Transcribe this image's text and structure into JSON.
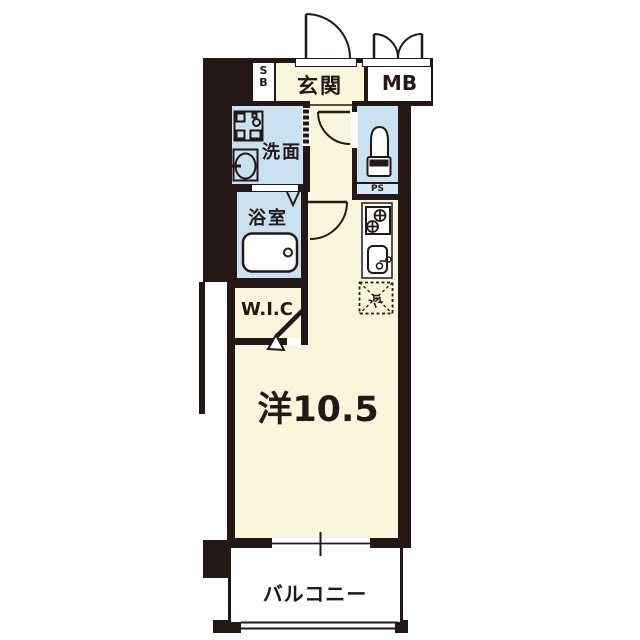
{
  "figure": {
    "type": "japanese-apartment-floor-plan"
  },
  "labels": {
    "genkan": "玄関",
    "shoes_box_line1": "S",
    "shoes_box_line2": "B",
    "meter_box": "MB",
    "washroom": "洗面",
    "bathroom": "浴室",
    "pipe_space": "PS",
    "walk_in_closet": "W.I.C",
    "main_room": "洋10.5",
    "balcony": "バルコニー",
    "refrigerator": "冷"
  },
  "fixtures": [
    "entrance-door",
    "meter-box-double-door",
    "accordion-door",
    "hall-door",
    "room-door",
    "bathroom-door-mark",
    "walk-in-closet-door",
    "washing-machine-pan",
    "vanity-sink",
    "bathtub",
    "toilet",
    "gas-stove",
    "kitchen-sink",
    "kitchen-counter",
    "refrigerator-space",
    "sliding-window",
    "balcony-railing"
  ],
  "colors": {
    "wall": "#231815",
    "floor-cream": "#FAF6DC",
    "wet-area-blue": "#C9E1F1",
    "ps-blue": "#D6E9F6",
    "paper": "#FFFFFF"
  }
}
